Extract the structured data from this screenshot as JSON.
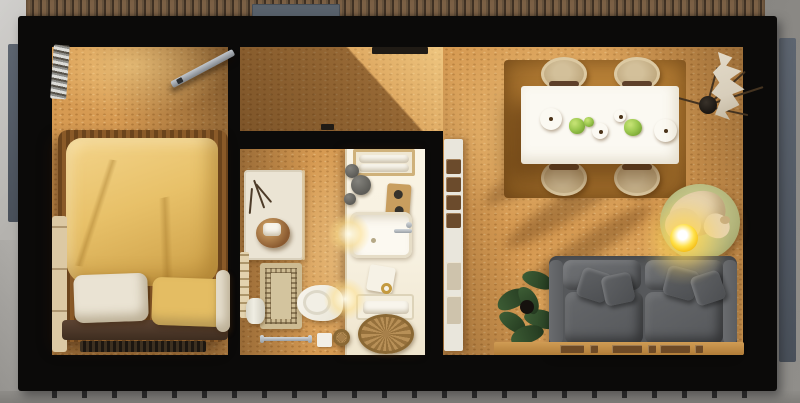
{
  "scene": {
    "type": "3d-floorplan-top-view",
    "description": "Top-down 3D render of a small one-bedroom cabin: bedroom (left), bathroom and entry hall (middle), open living-dining room (right), wood deck above, concrete ground around",
    "rooms": [
      {
        "name": "bedroom",
        "items": [
          "double-bed",
          "yellow-duvet",
          "chunky-knit-blanket",
          "white-pillow",
          "yellow-pillow",
          "headboard",
          "bedside-bench",
          "wall-ladder",
          "open-door-leaf",
          "foot-vent"
        ]
      },
      {
        "name": "entry-hall",
        "items": [
          "interior-doormat",
          "floor-track-mark"
        ]
      },
      {
        "name": "bathroom",
        "items": [
          "shower-tray",
          "shower-glass",
          "shower-stool",
          "decor-twigs",
          "wall-radiator",
          "patterned-bath-rug",
          "toilet",
          "trash-bin",
          "towel-rail",
          "soap-box",
          "small-basket",
          "vanity-counter",
          "towel-niche",
          "decor-stones",
          "soap-board",
          "sink-with-faucet",
          "tissue-box",
          "gold-ring-dish",
          "towel-tray",
          "rattan-basket",
          "counter-lights"
        ]
      },
      {
        "name": "living-dining",
        "items": [
          "wall-shelf-unit",
          "dining-rug",
          "dining-table",
          "dining-chair-x4",
          "dinner-plate-x2",
          "small-bowl-x2",
          "salad-greens-x3",
          "dried-branches",
          "black-vase",
          "dried-leaf-decor",
          "dog-bed",
          "sleeping-dog",
          "glowing-ball-lamp",
          "potted-plant",
          "gray-sofa",
          "throw-pillow-x4",
          "leaf-sculpture",
          "wall-ledge-with-books"
        ]
      }
    ],
    "exterior": [
      "concrete-ground",
      "wood-slat-deck",
      "outdoor-doormat",
      "facade-panels",
      "foundation-ticks"
    ]
  },
  "labels": {
    "scene": "Cabin floor plan - top view 3D render",
    "deck": "Wood slat deck",
    "deck_mat": "Outdoor doormat",
    "bedroom": "Bedroom",
    "hall": "Entry hall",
    "bathroom": "Bathroom",
    "living": "Living / dining room",
    "bed": "Double bed",
    "duvet": "Yellow duvet",
    "pillow_white": "White pillow",
    "pillow_yellow": "Yellow pillow",
    "headboard": "Headboard",
    "bench": "Bedside bench",
    "ladder": "Wall ladder",
    "door": "Open door leaf",
    "shower": "Shower tray",
    "stool": "Wooden stool with towel",
    "toilet": "Toilet",
    "bath_rug": "Patterned bath rug",
    "vanity": "Vanity counter",
    "sink": "Sink with faucet",
    "towel_niche": "Towel niche",
    "rattan_basket": "Rattan basket",
    "towel_rail": "Towel rail",
    "trash": "Trash bin",
    "shelf_unit": "Wall shelf unit",
    "dining_rug": "Dining area rug",
    "table": "Dining table",
    "chair": "Dining chair",
    "plate": "Dinner plate",
    "greens": "Salad greens",
    "branches": "Dried branches in vase",
    "cream_decor": "Dried leaf decor",
    "dog_bed": "Dog bed",
    "dog": "Sleeping dog",
    "lamp": "Glowing ball lamp",
    "plant": "Potted plant",
    "sofa": "Gray sofa",
    "throw": "Throw pillow",
    "ledge": "Wall ledge with books"
  },
  "palette": {
    "wall": "#0b0a09",
    "floor": "#d69a52",
    "deck": "#6a533c",
    "concrete": "#a5a39f",
    "panel": "#535a65",
    "duvet": "#e8c169",
    "blanket": "#8a5a28",
    "linen": "#eae3d3",
    "vanity": "#f7f1e1",
    "rug_bath": "#cdbb92",
    "rug_dining": "#a9742f",
    "table": "#fbf9f2",
    "chair": "#d3bf98",
    "sofa": "#595b5e",
    "plant": "#2f4a2b",
    "dog_bed": "#b4b67c",
    "dog": "#e7d3ad",
    "lamp": "#ffd63c",
    "basket": "#b08c52",
    "chrome": "#9aa0a6",
    "shelf": "#e9e6dc",
    "cream": "#d8cebb"
  }
}
